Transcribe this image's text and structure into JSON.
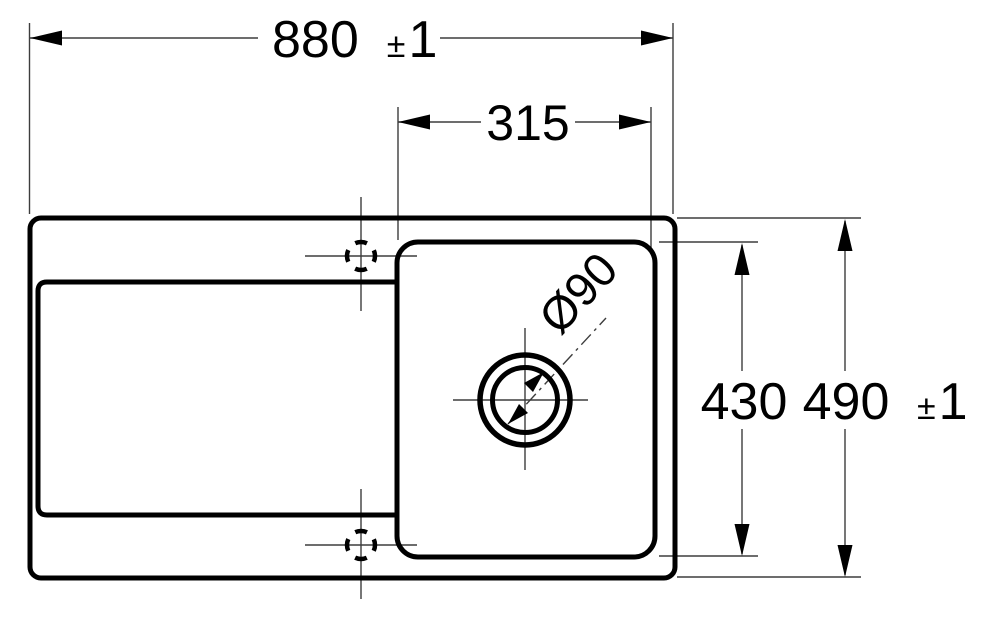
{
  "drawing": {
    "type": "technical-dimension-drawing",
    "subject": "kitchen sink top view with drainboard, bowl and drain hole",
    "colors": {
      "outline": "#000000",
      "dimension_line": "#3d3d3d",
      "background": "#ffffff"
    },
    "dims": {
      "width_overall": {
        "value": "880",
        "pm": "±",
        "tol": "1"
      },
      "width_bowl": {
        "value": "315"
      },
      "depth_bowl": {
        "value": "430"
      },
      "depth_overall": {
        "value": "490",
        "pm": "±",
        "tol": "1"
      },
      "drain_diameter": {
        "value": "Ø90"
      }
    }
  }
}
